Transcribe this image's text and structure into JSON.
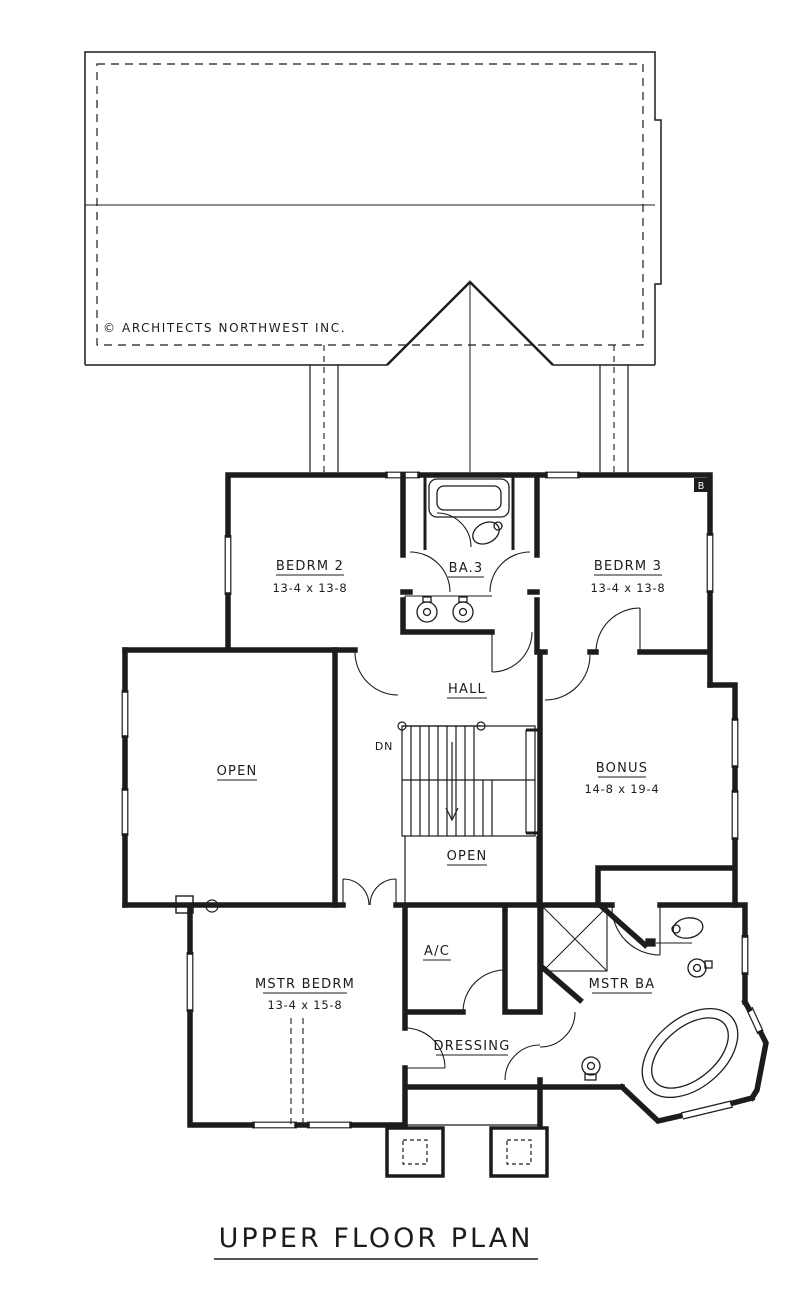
{
  "title_block": {
    "plan_title": "UPPER FLOOR PLAN"
  },
  "roof": {
    "copyright": "© ARCHITECTS NORTHWEST INC."
  },
  "rooms": {
    "bedrm2": {
      "label": "BEDRM 2",
      "dims": "13-4 x 13-8"
    },
    "bath": {
      "label": "BA.3"
    },
    "bedrm3": {
      "label": "BEDRM 3",
      "dims": "13-4 x 13-8"
    },
    "hall": {
      "label": "HALL"
    },
    "open_left": {
      "label": "OPEN"
    },
    "open_center": {
      "label": "OPEN"
    },
    "bonus": {
      "label": "BONUS",
      "dims": "14-8 x 19-4"
    },
    "mstr_bedrm": {
      "label": "MSTR BEDRM",
      "dims": "13-4 x 15-8"
    },
    "ac": {
      "label": "A/C"
    },
    "mstr_ba": {
      "label": "MSTR BA"
    },
    "dressing": {
      "label": "DRESSING"
    }
  },
  "stairs": {
    "direction_label": "DN"
  },
  "markers": {
    "window_marker": "B"
  },
  "colors": {
    "line": "#1c1c1c",
    "background": "#ffffff"
  }
}
